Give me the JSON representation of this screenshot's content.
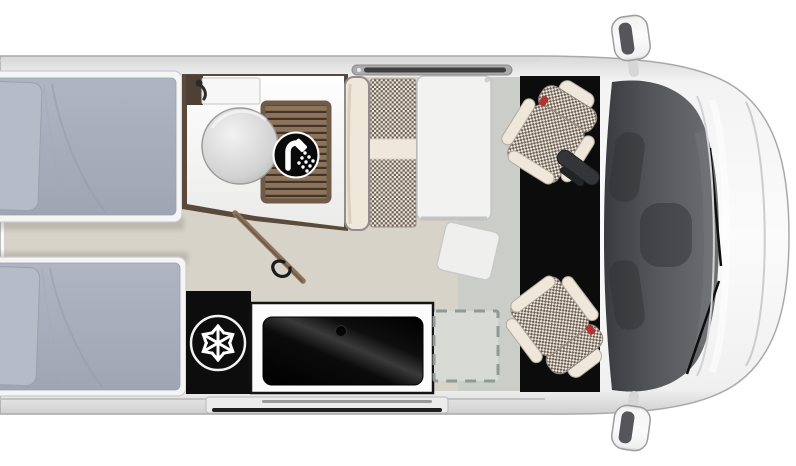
{
  "meta": {
    "title": "Camper van floor plan top view",
    "visible_text": ""
  },
  "icons": {
    "snowflake": {
      "name": "snowflake-icon",
      "glyph": "❄",
      "color": "#ffffff",
      "background": "#0d0d0d"
    },
    "shower": {
      "name": "shower-icon",
      "glyph": "🚿",
      "color": "#ffffff",
      "background": "#0a0a0a"
    }
  },
  "colors": {
    "canvas_bg": "#ffffff",
    "body_outline": "#a9a9a9",
    "floor": "#d7d3c8",
    "entry_floor": "#cbcdc8",
    "cab_mat": "#0c0c0c",
    "fridge": "#0d0d0d",
    "counter_edge": "#141414",
    "mattress": "#a8adbc",
    "pillow": "#b6bbc8",
    "bed_frame": "#f5f5f5",
    "bathroom_floor": "#fdfdfd",
    "wall_brown": "#5a4a3b",
    "door_brown": "#8b7258",
    "duckboard_slat": "#8d7359",
    "duckboard_gap": "#41352a",
    "seat_cream": "#efe8da",
    "hound_dark": "#6a5d52",
    "hound_light": "#f0eade",
    "table": "#f2f2f1",
    "windshield_dark": "#46484b",
    "dashed_zone_border": "#8f9a97",
    "dashed_zone_fill": "#d8dbd5",
    "rail_dark": "#3f3f3f",
    "accent_red": "#b23333"
  }
}
